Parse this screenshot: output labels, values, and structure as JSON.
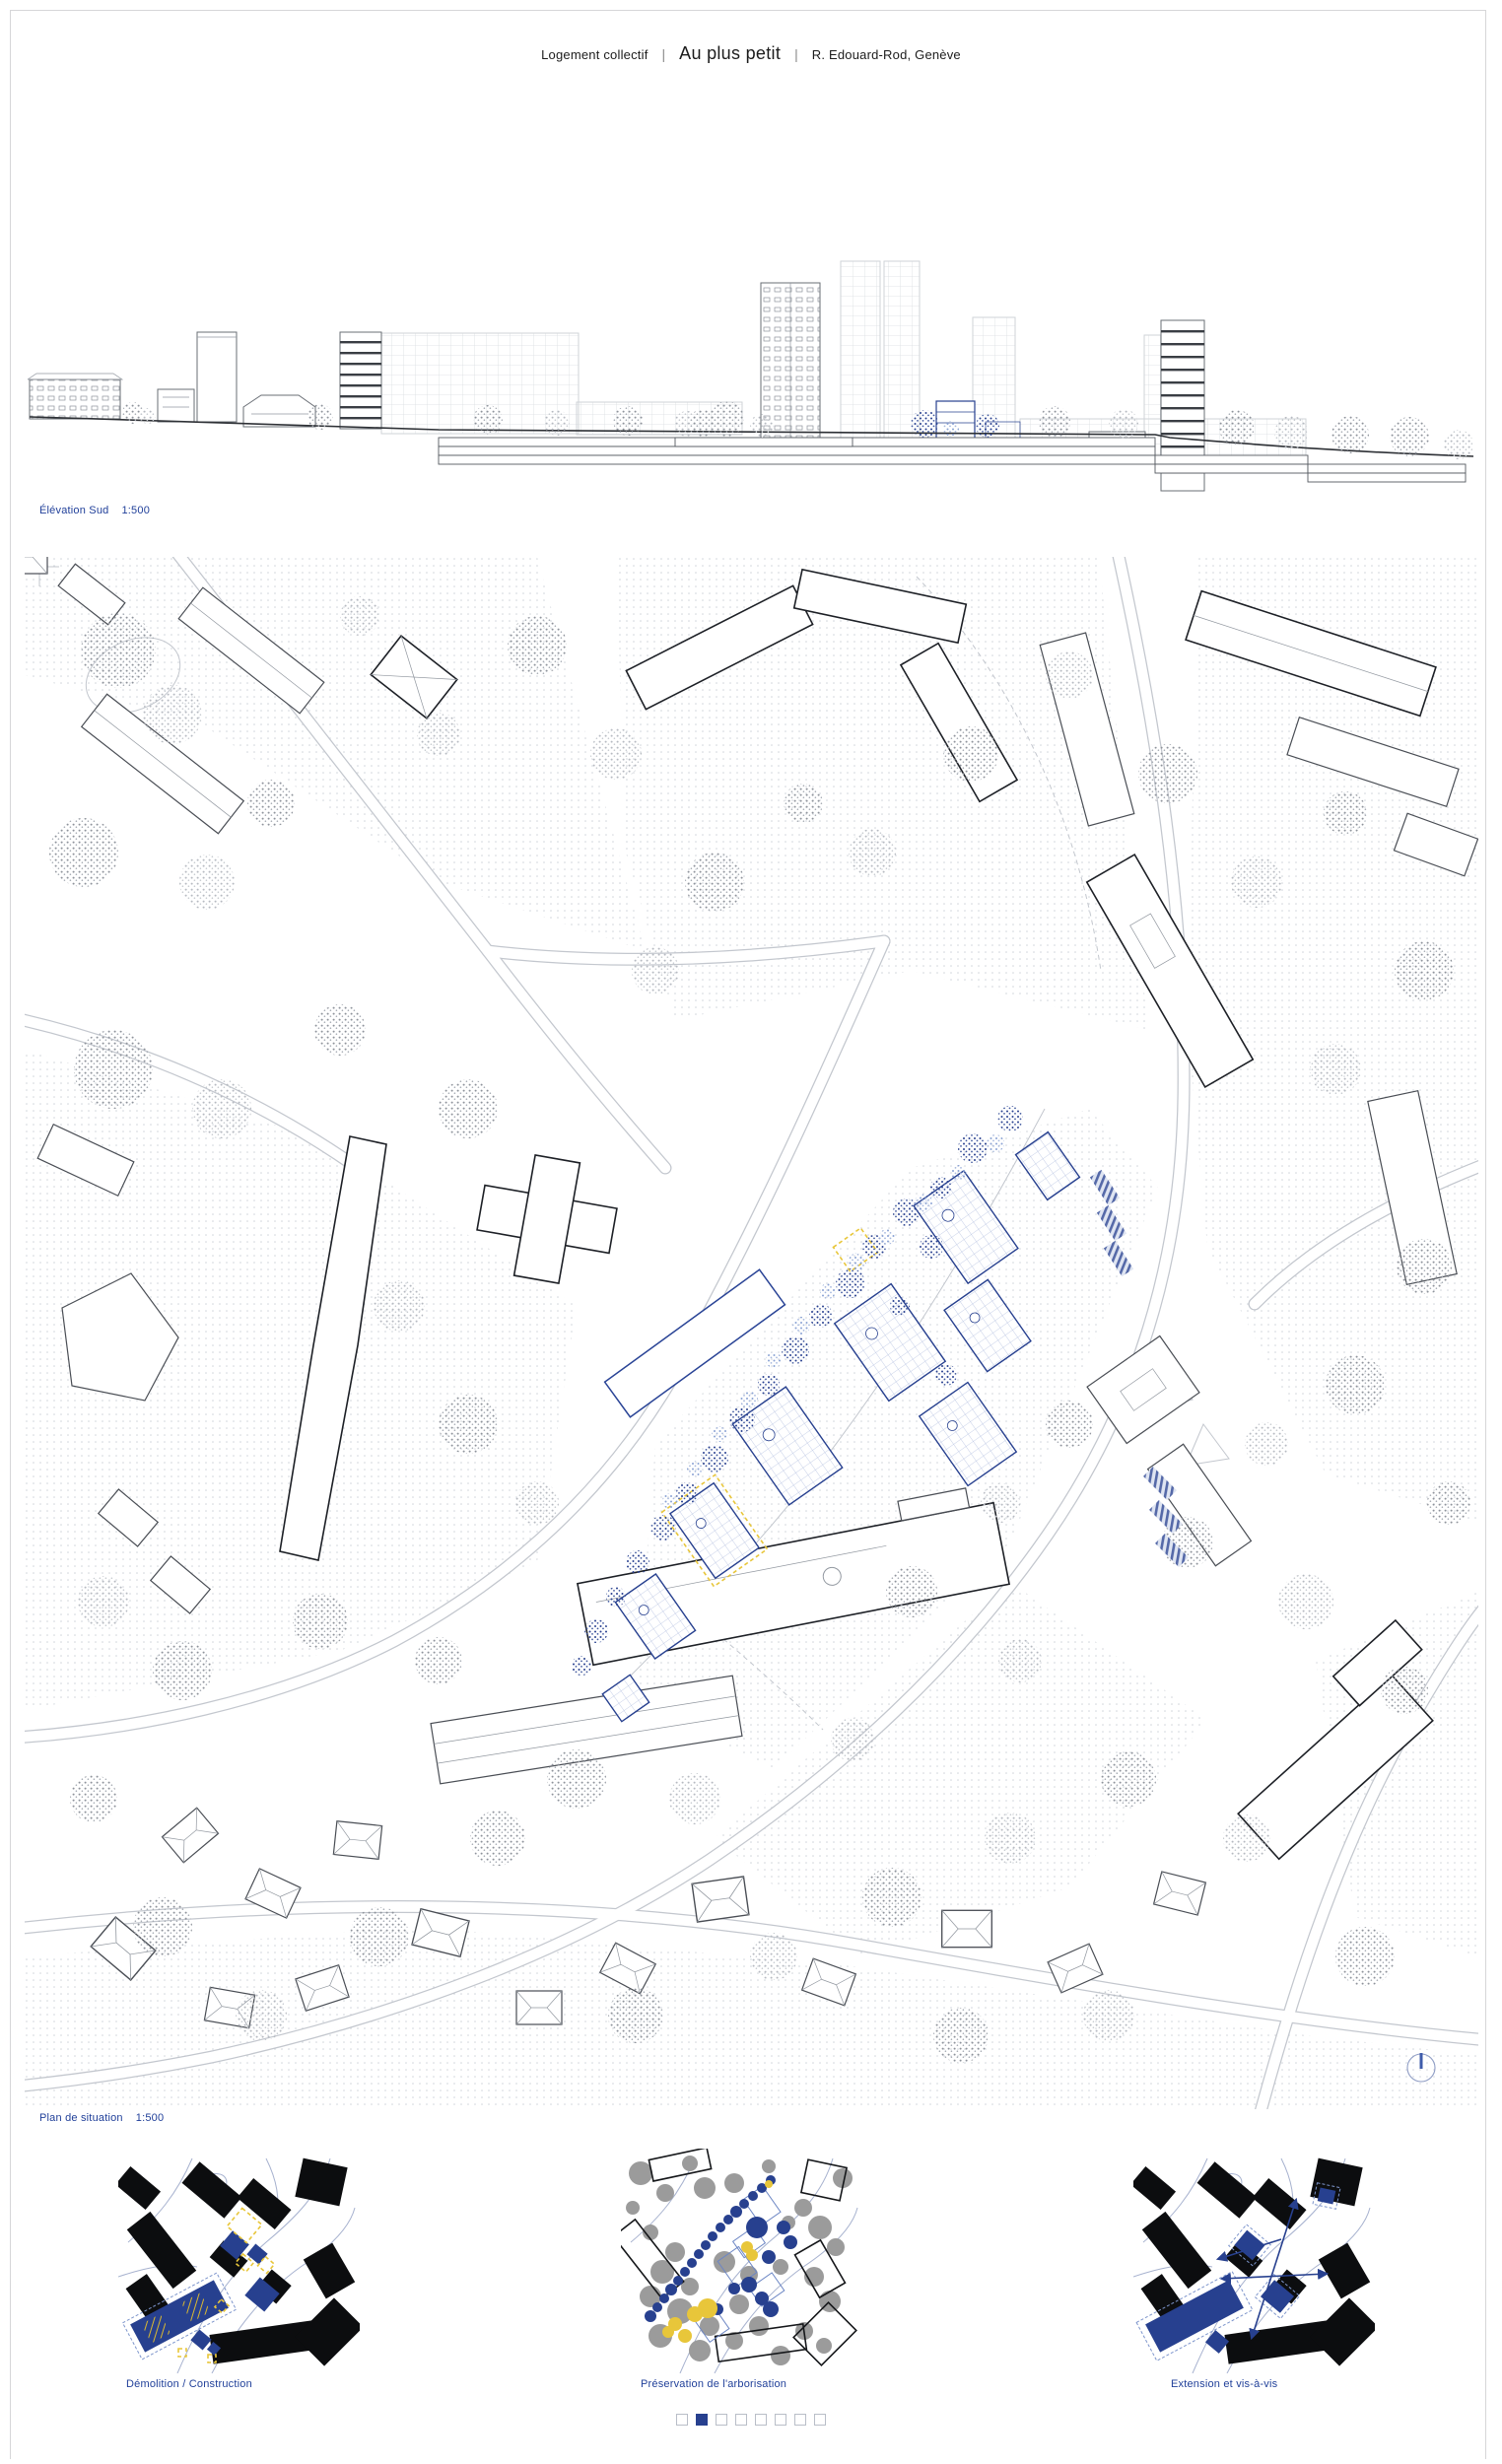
{
  "board": {
    "title": {
      "category": "Logement collectif",
      "separator": "|",
      "project": "Au plus petit",
      "location": "R. Edouard-Rod, Genève"
    }
  },
  "colors": {
    "accent_blue": "#21409a",
    "proposal_blue": "#27408f",
    "proposal_light_blue": "#8aa2d4",
    "highlight_yellow": "#e8c63a"
  },
  "drawings": {
    "elevation": {
      "label": "Élévation Sud",
      "scale": "1:500"
    },
    "site_plan": {
      "label": "Plan de situation",
      "scale": "1:500"
    }
  },
  "diagrams": [
    {
      "label": "Démolition / Construction"
    },
    {
      "label": "Préservation de l'arborisation"
    },
    {
      "label": "Extension et vis-à-vis"
    }
  ],
  "pagination": {
    "total": 8,
    "active_index": 2
  }
}
